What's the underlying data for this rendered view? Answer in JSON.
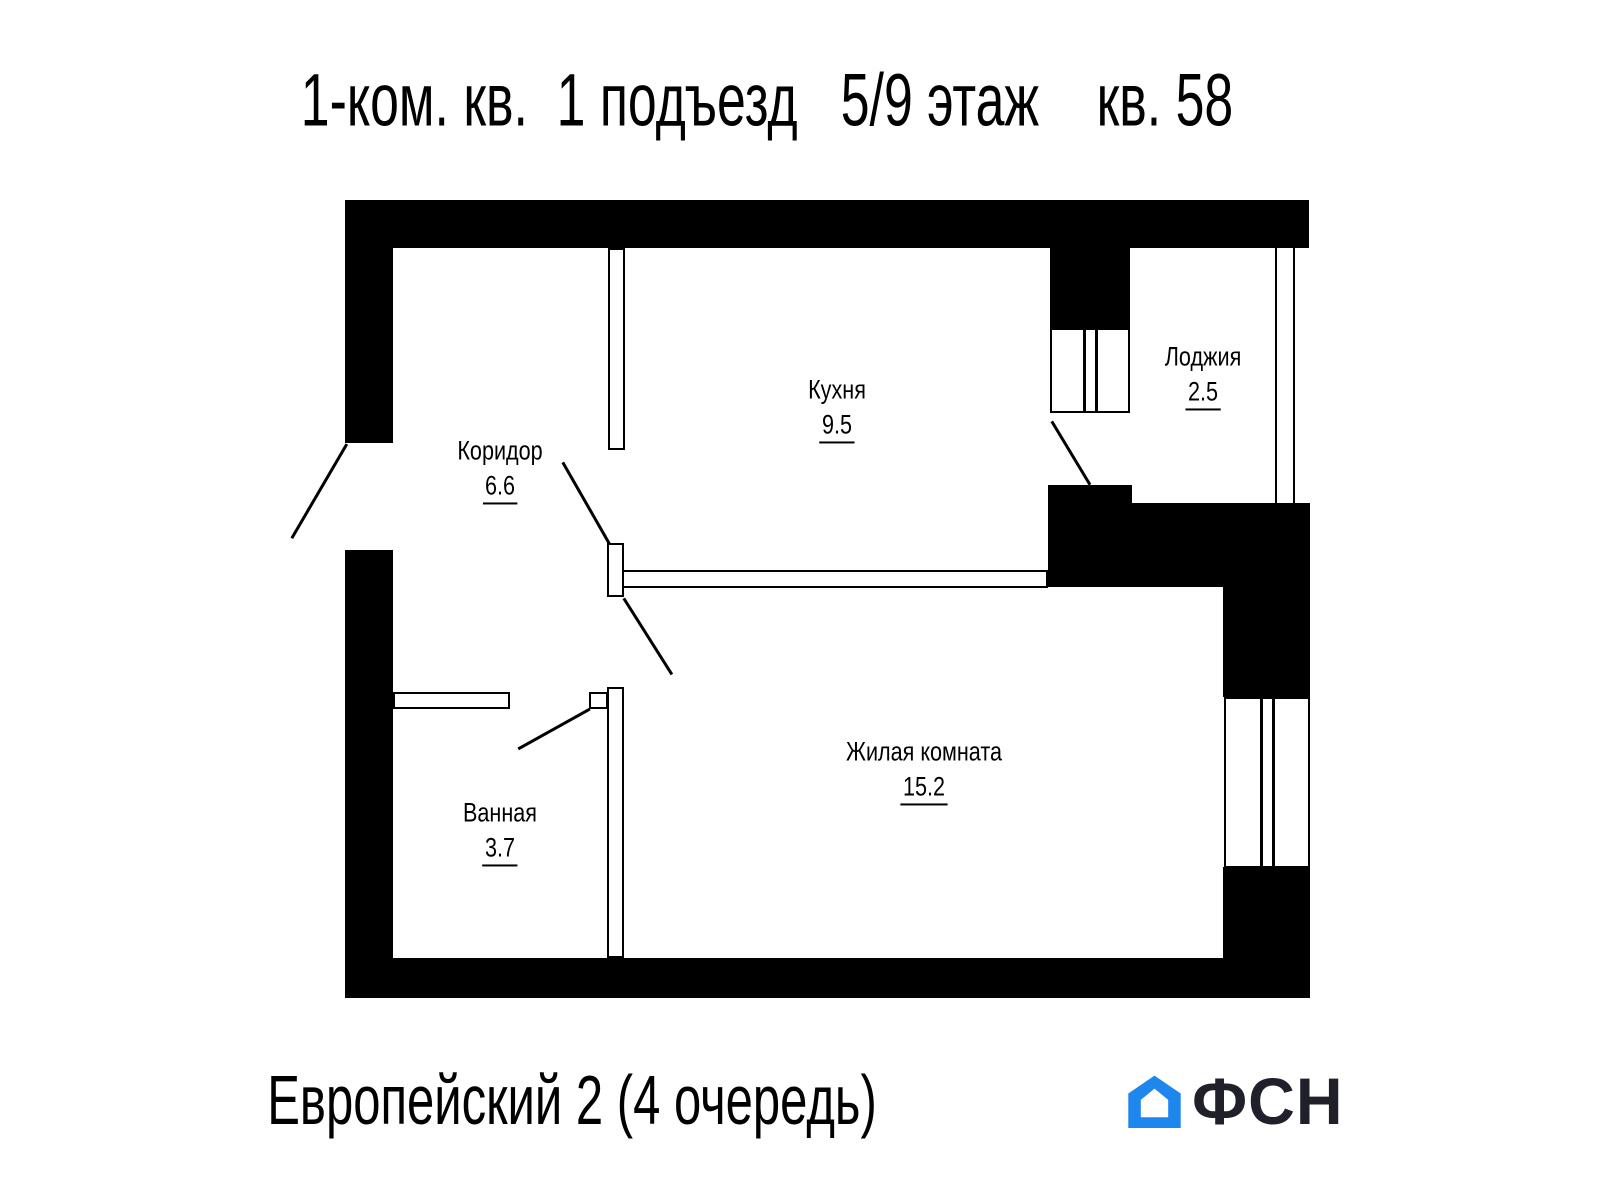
{
  "header": {
    "title": "1-ком. кв.  1 подъезд   5/9 этаж    кв. 58"
  },
  "plan": {
    "rooms": [
      {
        "name": "Кухня",
        "area": "9.5"
      },
      {
        "name": "Лоджия",
        "area": "2.5"
      },
      {
        "name": "Коридор",
        "area": "6.6"
      },
      {
        "name": "Ванная",
        "area": "3.7"
      },
      {
        "name": "Жилая комната",
        "area": "15.2"
      }
    ]
  },
  "footer": {
    "project": "Европейский 2 (4 очередь)",
    "logo_text": "ФСН"
  },
  "colors": {
    "walls": "#000000",
    "logo_blue": "#1e87ee",
    "logo_dark": "#20202a"
  }
}
